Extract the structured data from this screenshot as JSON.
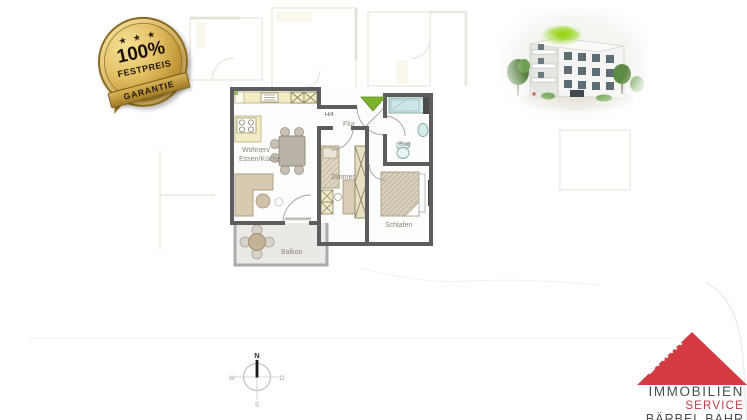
{
  "canvas": {
    "width": 747,
    "height": 420,
    "background": "#ffffff"
  },
  "badge": {
    "stars": "★ ★ ★",
    "percent": "100%",
    "title": "FESTPREIS",
    "subtitle": "GARANTIE",
    "gold": "#c49a3a"
  },
  "floor_plan": {
    "unit_label": "H/4",
    "labels": {
      "living_line1": "Wohnen/",
      "living_line2": "Essen/Küche",
      "hall": "Flur",
      "bath": "Bad",
      "room": "Zimmer",
      "bedroom": "Schlafen",
      "balcony": "Balkon"
    },
    "colors": {
      "wall": "#5d5d5d",
      "kitchen_fill": "#f2ecc4",
      "bath_fill": "#cfe6e6",
      "furniture_fill": "#d7cab1",
      "balcony_fill": "#ebe9e5",
      "entrance_arrow": "#7db32a",
      "label_color": "#8b8377"
    }
  },
  "compass": {
    "n": "N",
    "e": "O",
    "s": "S",
    "w": "W"
  },
  "logo": {
    "brand": "BAHR",
    "line1": "IMMOBILIEN",
    "line2": "SERVICE",
    "line3": "BÄRBEL BAHR",
    "colors": {
      "triangle": "#d33a41",
      "text_dark": "#4c4c4c",
      "text_red": "#c23a49"
    }
  },
  "building": {
    "description": "apartment-building-rendering"
  }
}
